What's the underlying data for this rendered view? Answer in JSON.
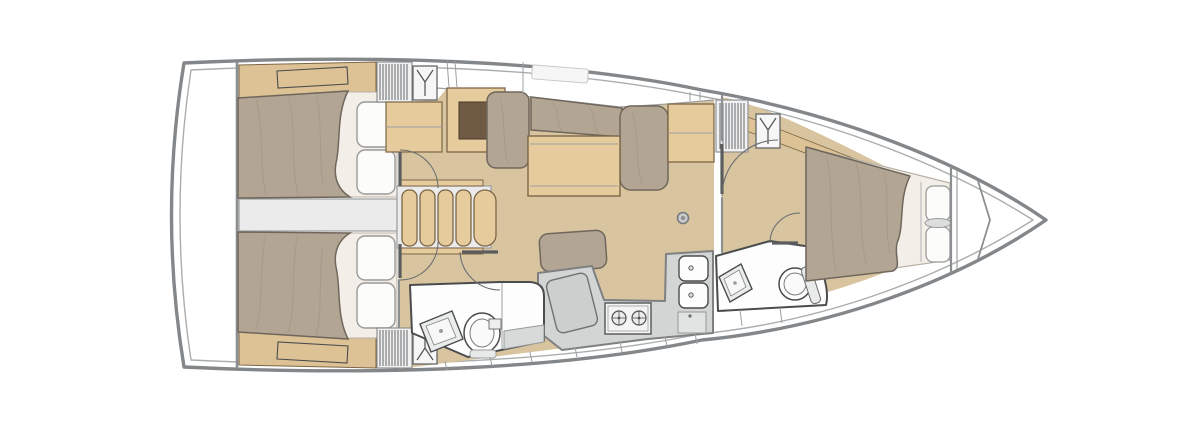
{
  "background": "#ffffff",
  "palette": {
    "background": "#ffffff",
    "hull_line": "#84878a",
    "deck_line": "#aaadae",
    "wall": "#8d9092",
    "fixture_line": "#4a4c4e",
    "floor_wood": "#d8c5a0",
    "strip_wood": "#dcc294",
    "furniture_wood": "#e6cb9c",
    "wood_edge": "#7c6647",
    "wood_dark": "#6f5b43",
    "upholstery": "#b3a593",
    "upholstery_edge": "#6f675c",
    "linen": "#f3efe8",
    "pillow": "#fcfcfb",
    "pillow_edge": "#9a9a98",
    "counter": "#d3d5d5",
    "counter_edge": "#7e8082",
    "fixture_white": "#fdfdfd",
    "gray_panel": "#ebebec"
  },
  "plan": {
    "type": "sailboat-interior-deck-plan",
    "orientation": "bow-right",
    "rooms": [
      {
        "name": "aft-cabin-port",
        "features": [
          "double-berth",
          "two-pillows",
          "hanging-locker",
          "shelf"
        ]
      },
      {
        "name": "aft-cabin-starboard",
        "features": [
          "double-berth",
          "two-pillows",
          "hanging-locker",
          "shelf"
        ]
      },
      {
        "name": "saloon",
        "features": [
          "l-settee",
          "saloon-table",
          "sideboard",
          "chart-locker",
          "nav-seat",
          "mast-post",
          "companionway-stairs",
          "engine-compartment"
        ]
      },
      {
        "name": "galley",
        "features": [
          "two-burner-stove",
          "double-sink",
          "worktop",
          "lockers"
        ]
      },
      {
        "name": "aft-head",
        "features": [
          "toilet",
          "washbasin",
          "shower-bench"
        ]
      },
      {
        "name": "forward-cabin",
        "features": [
          "island-berth",
          "two-pillows",
          "bedside-shelf",
          "hanging-locker"
        ]
      },
      {
        "name": "forward-head",
        "features": [
          "toilet",
          "washbasin"
        ]
      },
      {
        "name": "bow",
        "features": [
          "collision-bulkhead",
          "anchor-locker"
        ]
      }
    ],
    "counts": {
      "cabins": 3,
      "heads": 2,
      "double-berths": 3
    }
  },
  "icons": {
    "hanging_locker_symbol": "wire-hanger-Y-glyph",
    "stove_symbol": "two-burner-rings",
    "sink_symbol": "rounded-basin-with-drain"
  }
}
